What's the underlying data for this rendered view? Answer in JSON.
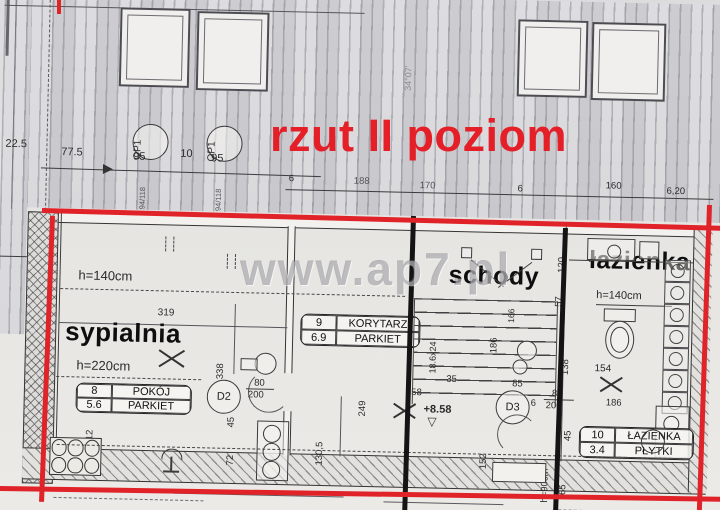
{
  "title": "rzut II poziom",
  "watermark": "www.ap7.pl",
  "roof": {
    "skylight_label": "OP1",
    "skylight_size": "94/118",
    "angle": "34°07'",
    "dims": {
      "a": "22.5",
      "b": "77.5",
      "c": "95",
      "d": "10",
      "e": "95",
      "f": "6",
      "g": "188",
      "h": "170",
      "i": "6",
      "j": "160",
      "k": "6,20"
    }
  },
  "elevation": "+8.58",
  "elevation_mark": "▽",
  "rooms": {
    "bedroom": {
      "label": "sypialnia",
      "h_upper": "h=140cm",
      "h_lower": "h=220cm",
      "table": {
        "no": "8",
        "name": "POKÓJ",
        "area": "5.6",
        "floor": "PARKIET"
      },
      "dims": {
        "width": "319",
        "depth": "338",
        "a": "12",
        "b": "45",
        "c": "72"
      }
    },
    "corridor": {
      "table": {
        "no": "9",
        "name": "KORYTARZ",
        "area": "6.9",
        "floor": "PARKIET"
      },
      "dims": {
        "a": "130,5",
        "b": "249",
        "c": "358",
        "d": "35"
      }
    },
    "stairs": {
      "label": "schody",
      "tread": "18.6x24",
      "dims": {
        "a": "186",
        "b": "166",
        "c": "85"
      }
    },
    "bathroom": {
      "label": "łazienka",
      "h_top": "h=140cm",
      "h_knee": "h=90cm",
      "table": {
        "no": "10",
        "name": "ŁAZIENKA",
        "area": "3.4",
        "floor": "PŁYTKI"
      },
      "dims": {
        "a": "120",
        "b": "57",
        "c": "138",
        "d": "154",
        "e": "186",
        "f": "45",
        "g": "65",
        "h": "152"
      }
    }
  },
  "doors": {
    "d2": {
      "label": "D2",
      "w": "80",
      "h": "200"
    },
    "d3": {
      "label": "D3",
      "w": "80",
      "h": "200",
      "gap": "6"
    }
  }
}
